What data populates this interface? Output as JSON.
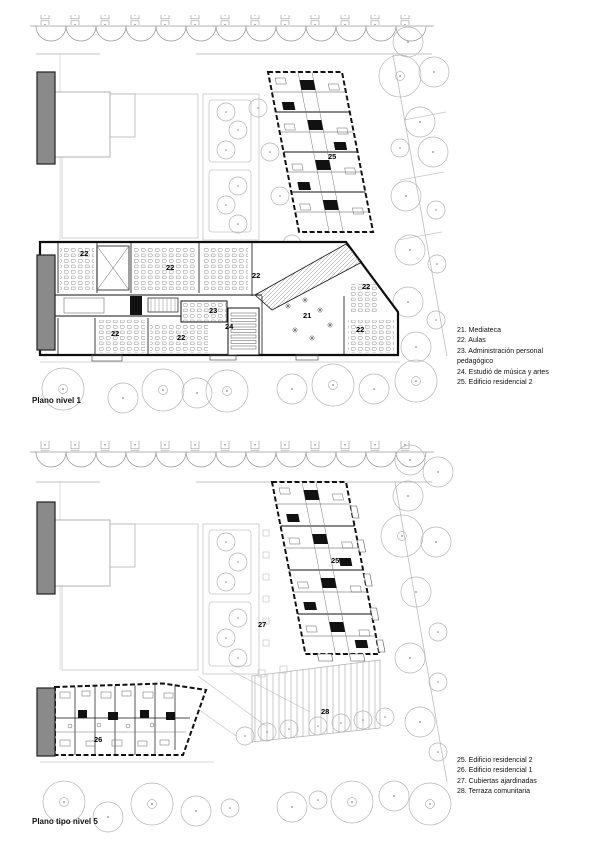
{
  "colors": {
    "wall_black": "#111111",
    "landscape_gray": "#b5b5b5",
    "building_gray_fill": "#8a8a8a",
    "paper_white": "#ffffff"
  },
  "plan1": {
    "caption": "Plano nivel 1",
    "legend_lines": [
      "21. Mediateca",
      "22. Aulas",
      "23. Administración personal",
      "pedagógico",
      "24. Estudió de música y artes",
      "25. Edificio residencial 2"
    ],
    "room_labels": [
      {
        "text": "25",
        "x": 328,
        "y": 152
      },
      {
        "text": "22",
        "x": 80,
        "y": 249
      },
      {
        "text": "22",
        "x": 166,
        "y": 263
      },
      {
        "text": "22",
        "x": 252,
        "y": 271
      },
      {
        "text": "22",
        "x": 362,
        "y": 282
      },
      {
        "text": "23",
        "x": 209,
        "y": 306
      },
      {
        "text": "21",
        "x": 303,
        "y": 311
      },
      {
        "text": "24",
        "x": 225,
        "y": 322
      },
      {
        "text": "22",
        "x": 111,
        "y": 329
      },
      {
        "text": "22",
        "x": 177,
        "y": 333
      },
      {
        "text": "22",
        "x": 356,
        "y": 325
      }
    ]
  },
  "plan2": {
    "caption": "Plano tipo nivel 5",
    "legend_lines": [
      "25. Edificio residencial 2",
      "26. Edificio residencial 1",
      "27. Cubiertas ajardinadas",
      "28. Terraza comunitaria"
    ],
    "room_labels": [
      {
        "text": "25",
        "x": 331,
        "y": 556
      },
      {
        "text": "27",
        "x": 258,
        "y": 620
      },
      {
        "text": "28",
        "x": 321,
        "y": 707
      },
      {
        "text": "26",
        "x": 94,
        "y": 735
      }
    ]
  }
}
